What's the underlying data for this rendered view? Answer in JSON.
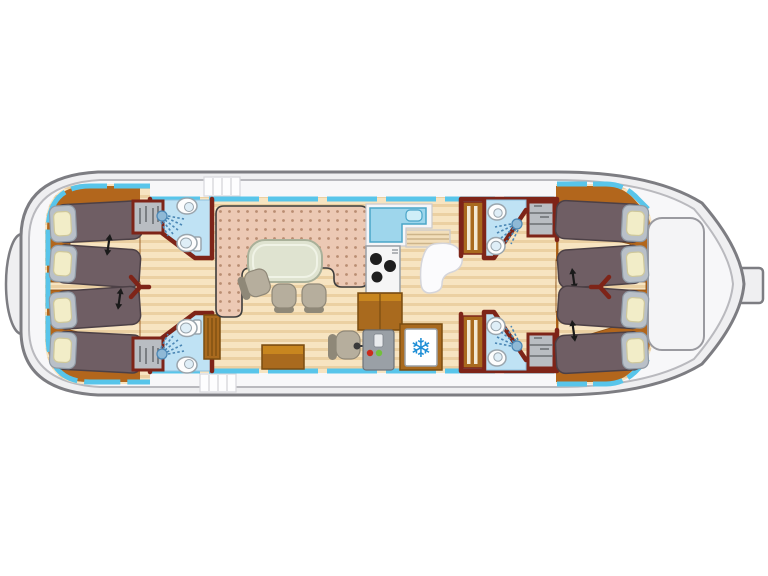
{
  "scene": {
    "type": "houseboat-deck-plan",
    "berths": 8,
    "cabins": 4,
    "bathrooms": 4,
    "areas": [
      "bow-cabins",
      "fore-bathrooms",
      "saloon",
      "galley",
      "helm",
      "refrigerator",
      "aft-bathrooms",
      "stern-cabins",
      "aft-deck",
      "rudder"
    ]
  },
  "icons": {
    "snowflake": "❄"
  },
  "colors": {
    "bg": "#ffffff",
    "hull-fill": "#efeff1",
    "hull-stroke": "#7d7d82",
    "hull-inner": "#f7f7f9",
    "hull-inner-stroke": "#b9b9be",
    "white-panel": "#f4f4f6",
    "white-panel-stroke": "#9a9aa0",
    "deck-line": "#d8d8dc",
    "window-cyan": "#58c5ea",
    "wall": "#7e2418",
    "wood-base": "#f7e4c1",
    "wood-stripe": "#ebd0a2",
    "platform": "#b2661c",
    "platform-dark": "#8a4b10",
    "cabinet": "#a96a1e",
    "cabinet-dark": "#7a4c10",
    "cabinet-light": "#c8861f",
    "bed": "#6f5e64",
    "bed-stroke": "#4c4046",
    "bed-head": "#b9c0c8",
    "bed-head-stroke": "#8f99a4",
    "pillow": "#f2edc8",
    "pillow-stroke": "#cfc89b",
    "sofa": "#ecc9b4",
    "sofa-dot": "#b98d72",
    "sofa-stroke": "#3d3d3d",
    "table": "#dfe3d0",
    "table-stroke": "#a9b099",
    "chair": "#b6ae9d",
    "chair-dark": "#8f8878",
    "bath": "#bfe2f4",
    "bath-stroke": "#8fc2e0",
    "fixture": "#fdfdfd",
    "fixture-stroke": "#9aa5ad",
    "fixture-inner": "#dfeef7",
    "spray": "#4a86b4",
    "showerhead": "#8fb9d6",
    "galley-sink": "#9ed6ec",
    "galley-sink-stroke": "#4aa5c8",
    "galley-sink-bowl": "#cfeef8",
    "counter": "#f6f6f8",
    "counter-stroke": "#c9c9ce",
    "stove": "#f5f5f5",
    "stove-stroke": "#9aa0a6",
    "burner": "#1e1e1e",
    "console": "#9aa0a6",
    "btn-red": "#cc2a1a",
    "btn-green": "#72bf3a",
    "fridge": "#ffffff",
    "snowflake": "#1f8fd6",
    "steps": "#f2debb",
    "steps-line": "#cdb48a",
    "arrow": "#1a1a1a",
    "wardrobe": "#b9bdc2",
    "wardrobe-dark": "#6a6e73",
    "door-slat": "#f3e9d4"
  }
}
